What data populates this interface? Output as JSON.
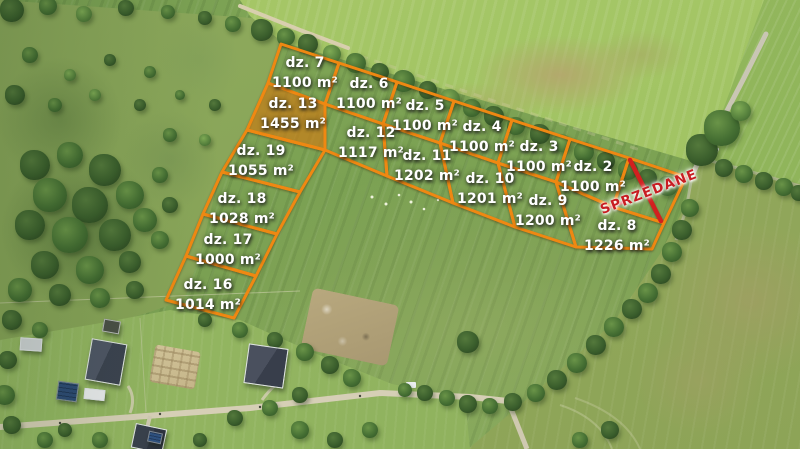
{
  "style": {
    "boundary_color": "#ef8812",
    "highlight_fill": "rgba(236,142,24,0.55)",
    "label_text_color": "#ffffff",
    "sold_color": "#d2201f"
  },
  "plots": [
    {
      "id": "dz-7",
      "name": "dz. 7",
      "area": "1100 m²",
      "label_x": 305,
      "label_y": 73,
      "points": "281,44 339,63 325,104 268,83",
      "highlighted": false
    },
    {
      "id": "dz-6",
      "name": "dz. 6",
      "area": "1100 m²",
      "label_x": 369,
      "label_y": 94,
      "points": "339,63 397,82 383,124 325,104",
      "highlighted": false
    },
    {
      "id": "dz-5",
      "name": "dz. 5",
      "area": "1100 m²",
      "label_x": 425,
      "label_y": 116,
      "points": "397,82 454,101 440,143 383,124",
      "highlighted": false
    },
    {
      "id": "dz-4",
      "name": "dz. 4",
      "area": "1100 m²",
      "label_x": 482,
      "label_y": 137,
      "points": "454,101 512,120 498,163 440,143",
      "highlighted": false
    },
    {
      "id": "dz-3",
      "name": "dz. 3",
      "area": "1100 m²",
      "label_x": 539,
      "label_y": 157,
      "points": "512,120 570,139 556,182 498,163",
      "highlighted": false
    },
    {
      "id": "dz-2",
      "name": "dz. 2",
      "area": "1100 m²",
      "label_x": 593,
      "label_y": 177,
      "points": "570,139 629,158 613,207 556,182",
      "highlighted": false
    },
    {
      "id": "dz-13",
      "name": "dz. 13",
      "area": "1455 m²",
      "label_x": 293,
      "label_y": 114,
      "points": "268,83 325,104 325,150 247,130",
      "highlighted": true
    },
    {
      "id": "dz-12",
      "name": "dz. 12",
      "area": "1117 m²",
      "label_x": 371,
      "label_y": 143,
      "points": "325,104 383,124 387,176 325,150",
      "highlighted": false
    },
    {
      "id": "dz-11",
      "name": "dz. 11",
      "area": "1202 m²",
      "label_x": 427,
      "label_y": 166,
      "points": "383,124 440,143 453,203 387,176",
      "highlighted": false
    },
    {
      "id": "dz-10",
      "name": "dz. 10",
      "area": "1201 m²",
      "label_x": 490,
      "label_y": 189,
      "points": "440,143 498,163 515,227 453,203",
      "highlighted": false
    },
    {
      "id": "dz-9",
      "name": "dz. 9",
      "area": "1200 m²",
      "label_x": 548,
      "label_y": 211,
      "points": "498,163 556,182 576,247 515,227",
      "highlighted": false
    },
    {
      "id": "dz-8",
      "name": "dz. 8",
      "area": "1226 m²",
      "label_x": 617,
      "label_y": 236,
      "points": "556,182 613,207 664,223 652,249 576,247",
      "highlighted": false
    },
    {
      "id": "dz-19",
      "name": "dz. 19",
      "area": "1055 m²",
      "label_x": 261,
      "label_y": 161,
      "points": "247,130 325,150 300,192 222,172",
      "highlighted": false
    },
    {
      "id": "dz-18",
      "name": "dz. 18",
      "area": "1028 m²",
      "label_x": 242,
      "label_y": 209,
      "points": "222,172 300,192 277,234 203,214",
      "highlighted": false
    },
    {
      "id": "dz-17",
      "name": "dz. 17",
      "area": "1000 m²",
      "label_x": 228,
      "label_y": 250,
      "points": "203,214 277,234 256,276 186,256",
      "highlighted": false
    },
    {
      "id": "dz-16",
      "name": "dz. 16",
      "area": "1014 m²",
      "label_x": 208,
      "label_y": 295,
      "points": "186,256 256,276 234,318 166,300",
      "highlighted": false
    }
  ],
  "sold_overlay": {
    "label": "SPRZEDANE",
    "points": "629,158 686,177 664,223 613,207",
    "text_x": 649,
    "text_y": 192,
    "cross_lines": [
      "630,160 661,221",
      "611,207 626,201",
      "674,183 686,178"
    ]
  }
}
